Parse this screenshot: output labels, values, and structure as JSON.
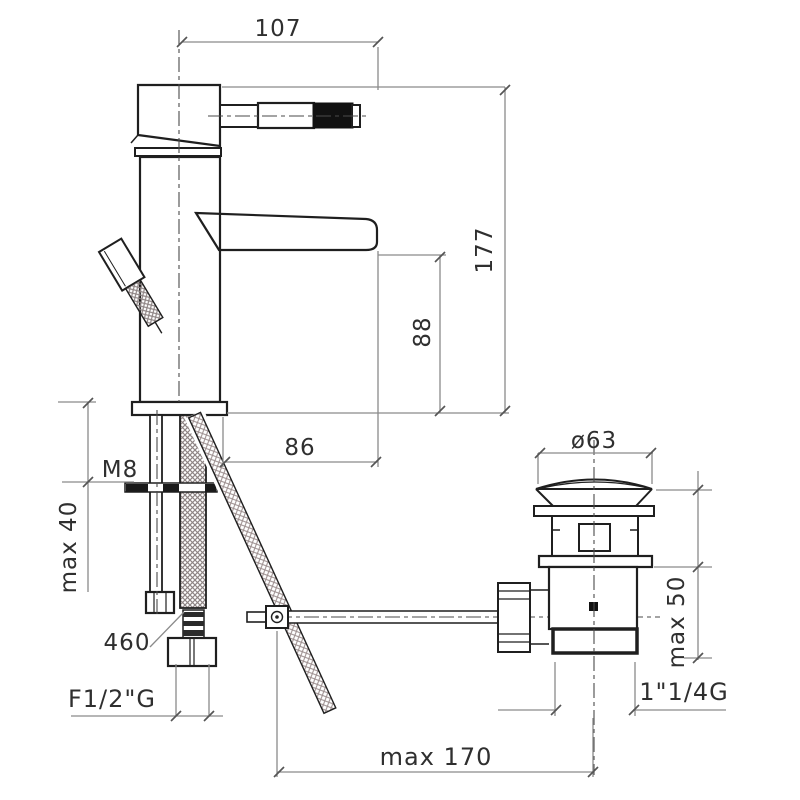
{
  "drawing": {
    "type": "technical-dimension-drawing",
    "subject": "single-lever basin mixer with pop-up waste",
    "colors": {
      "background": "#ffffff",
      "outline": "#1f1f1f",
      "dimension_lines": "#8a8a8a",
      "text": "#2f2f2f",
      "hatch": "#9a8c8c"
    },
    "labels": {
      "spout_projection_total": "107",
      "total_height": "177",
      "spout_height": "88",
      "spout_reach": "86",
      "fixing_stud_thread": "M8",
      "max_deck_thickness": "max 40",
      "hose_length": "460",
      "hose_connection_thread": "F1/2\"G",
      "waste_cap_diameter": "ø63",
      "waste_max_deck_thickness": "max 50",
      "waste_outlet_thread": "1\"1/4G",
      "rod_max_reach": "max 170"
    }
  }
}
